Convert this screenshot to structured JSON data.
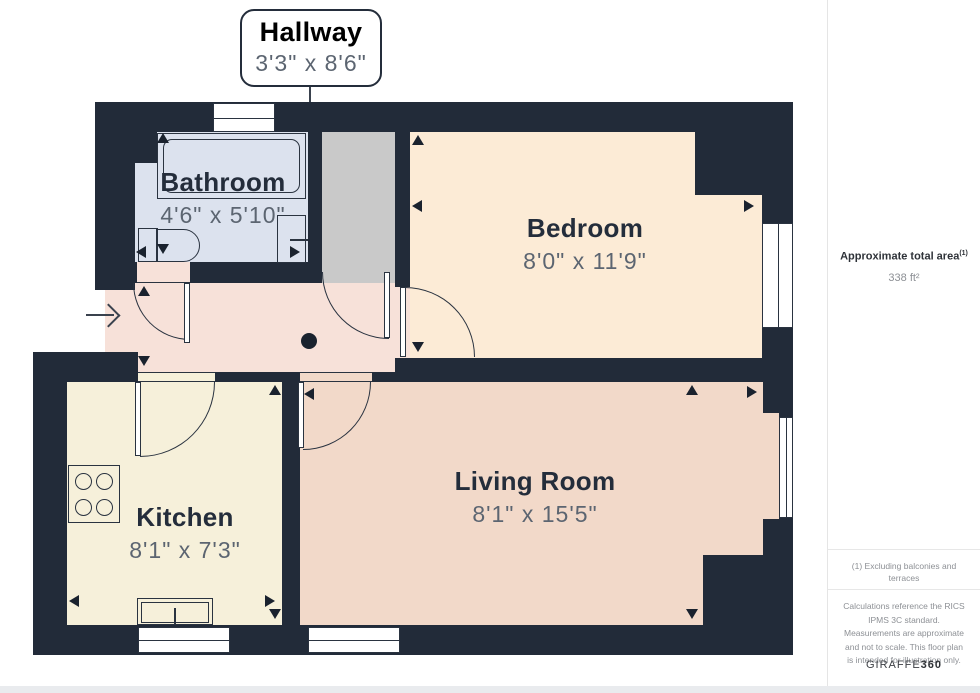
{
  "callout": {
    "room": "Hallway",
    "dims": "3'3\" x 8'6\""
  },
  "rooms": {
    "bathroom": {
      "name": "Bathroom",
      "dims": "4'6\" x 5'10\"",
      "floor_color": "#dce2ee"
    },
    "bedroom": {
      "name": "Bedroom",
      "dims": "8'0\" x 11'9\"",
      "floor_color": "#fcebd6"
    },
    "kitchen": {
      "name": "Kitchen",
      "dims": "8'1\" x 7'3\"",
      "floor_color": "#f6f0da"
    },
    "living_room": {
      "name": "Living Room",
      "dims": "8'1\" x 15'5\"",
      "floor_color": "#f2d9c9"
    },
    "hallway": {
      "floor_color": "#f7e1d9"
    },
    "closet": {
      "floor_color": "#c9c9c9"
    }
  },
  "sidebar": {
    "total_area_label": "Approximate total area",
    "total_area_superscript": "(1)",
    "total_area_value": "338 ft²",
    "footnote": "(1) Excluding balconies and terraces",
    "disclaimer": "Calculations reference the RICS IPMS 3C standard. Measurements are approximate and not to scale. This floor plan is intended for illustration only.",
    "brand_name": "GIRAFFE",
    "brand_suffix": "360"
  },
  "colors": {
    "wall": "#222b39",
    "label_ink": "#242d3b",
    "dims_text": "#5c6571"
  }
}
